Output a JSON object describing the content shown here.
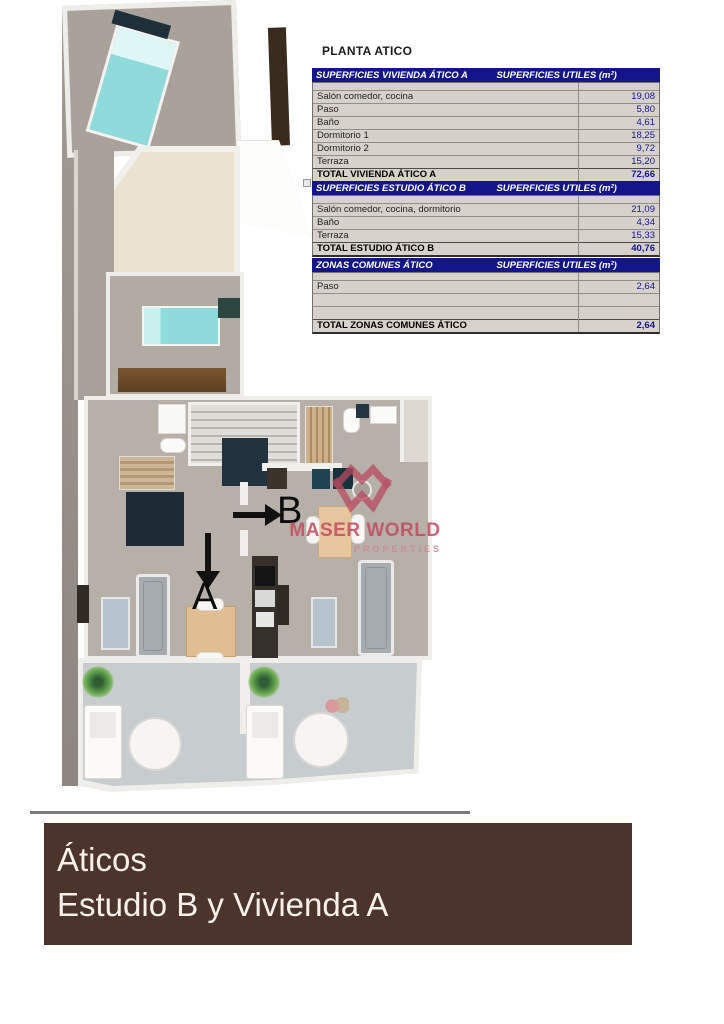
{
  "title": "PLANTA ATICO",
  "tables": [
    {
      "header_left": "SUPERFICIES VIVIENDA ÁTICO A",
      "header_right": "SUPERFICIES UTILES  (m²)",
      "rows": [
        {
          "label": "Salón comedor, cocina",
          "value": "19,08"
        },
        {
          "label": "Paso",
          "value": "5,80"
        },
        {
          "label": "Baño",
          "value": "4,61"
        },
        {
          "label": "Dormitorio 1",
          "value": "18,25"
        },
        {
          "label": "Dormitorio 2",
          "value": "9,72"
        },
        {
          "label": "Terraza",
          "value": "15,20"
        }
      ],
      "total_label": "TOTAL VIVIENDA ÁTICO A",
      "total_value": "72,66"
    },
    {
      "header_left": "SUPERFICIES ESTUDIO ÁTICO B",
      "header_right": "SUPERFICIES UTILES  (m²)",
      "rows": [
        {
          "label": "Salón comedor, cocina, dormitorio",
          "value": "21,09"
        },
        {
          "label": "Baño",
          "value": "4,34"
        },
        {
          "label": "Terraza",
          "value": "15,33"
        }
      ],
      "total_label": "TOTAL ESTUDIO ÁTICO B",
      "total_value": "40,76"
    },
    {
      "header_left": "ZONAS COMUNES ÁTICO",
      "header_right": "SUPERFICIES UTILES  (m²)",
      "rows": [
        {
          "label": "Paso",
          "value": "2,64"
        },
        {
          "label": "",
          "value": ""
        },
        {
          "label": "",
          "value": ""
        }
      ],
      "total_label": "TOTAL ZONAS COMUNES ÁTICO",
      "total_value": "2,64"
    }
  ],
  "plan": {
    "unit_a_label": "A",
    "unit_b_label": "B"
  },
  "watermark": {
    "brand": "MASER WORLD",
    "tagline": "PROPERTIES"
  },
  "banner": {
    "line1": "Áticos",
    "line2": "Estudio B y Vivienda A"
  },
  "colors": {
    "table_header_navy": "#15158a",
    "value_navy": "#15158a",
    "brand_crimson": "#b9495f",
    "banner_brown": "#4a342c"
  }
}
